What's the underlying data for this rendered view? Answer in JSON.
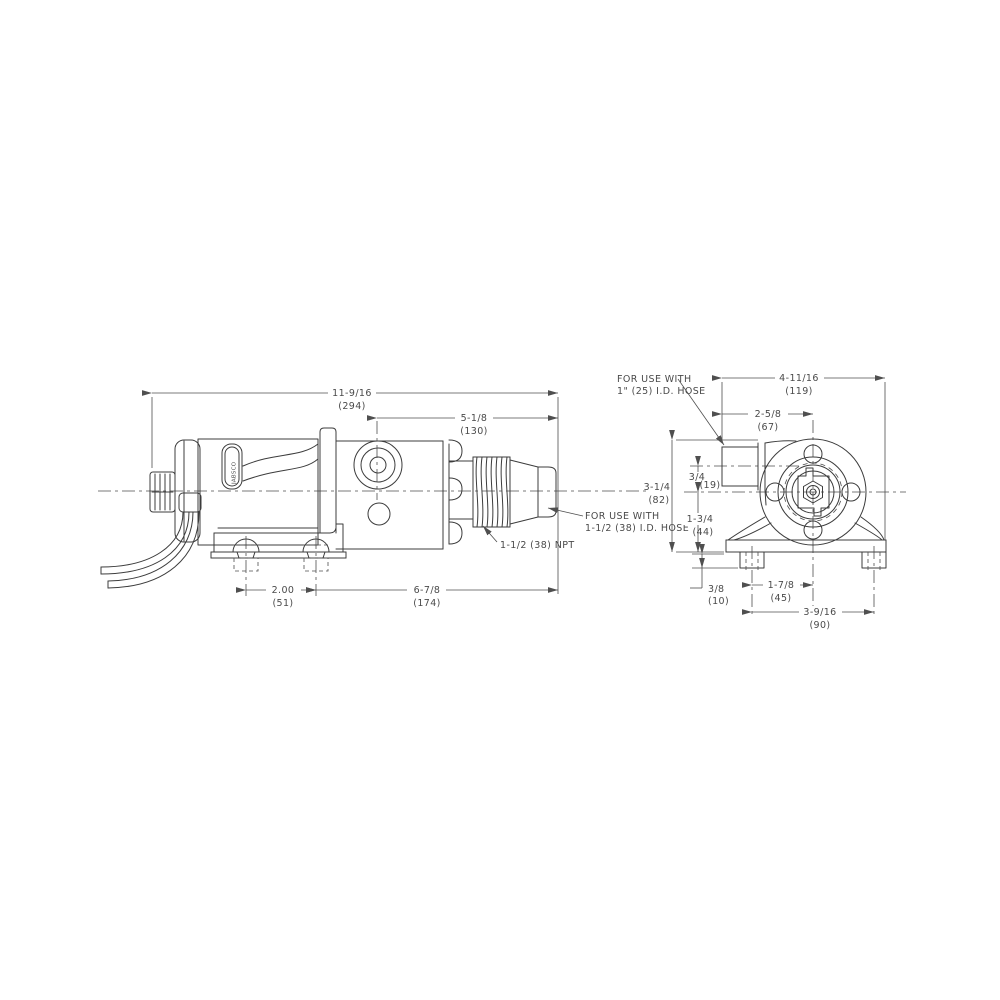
{
  "drawing": {
    "brand_label": "JABSCO",
    "ink_color": "#3c3c3c",
    "text_color": "#4a4a4a",
    "background_color": "#ffffff",
    "side_view": {
      "dim_overall_length": {
        "frac": "11-9/16",
        "mm": "(294)"
      },
      "dim_port_to_end": {
        "frac": "5-1/8",
        "mm": "(130)"
      },
      "dim_bolt_spacing": {
        "frac": "2.00",
        "mm": "(51)"
      },
      "dim_bolt_to_end": {
        "frac": "6-7/8",
        "mm": "(174)"
      },
      "npt_note": "1-1/2 (38) NPT",
      "hose_note_line1": "FOR USE WITH",
      "hose_note_line2": "1-1/2 (38) I.D. HOSE"
    },
    "end_view": {
      "dim_overall_width": {
        "frac": "4-11/16",
        "mm": "(119)"
      },
      "dim_port_center": {
        "frac": "2-5/8",
        "mm": "(67)"
      },
      "dim_overall_height": {
        "frac": "3-1/4",
        "mm": "(82)"
      },
      "dim_port_offset": {
        "frac": "3/4",
        "mm": "(19)"
      },
      "dim_center_height": {
        "frac": "1-3/4",
        "mm": "(44)"
      },
      "dim_foot_height": {
        "frac": "3/8",
        "mm": "(10)"
      },
      "dim_bolt_to_center": {
        "frac": "1-7/8",
        "mm": "(45)"
      },
      "dim_foot_spacing": {
        "frac": "3-9/16",
        "mm": "(90)"
      },
      "hose_note_line1": "FOR USE WITH",
      "hose_note_line2": "1\" (25) I.D. HOSE"
    }
  }
}
